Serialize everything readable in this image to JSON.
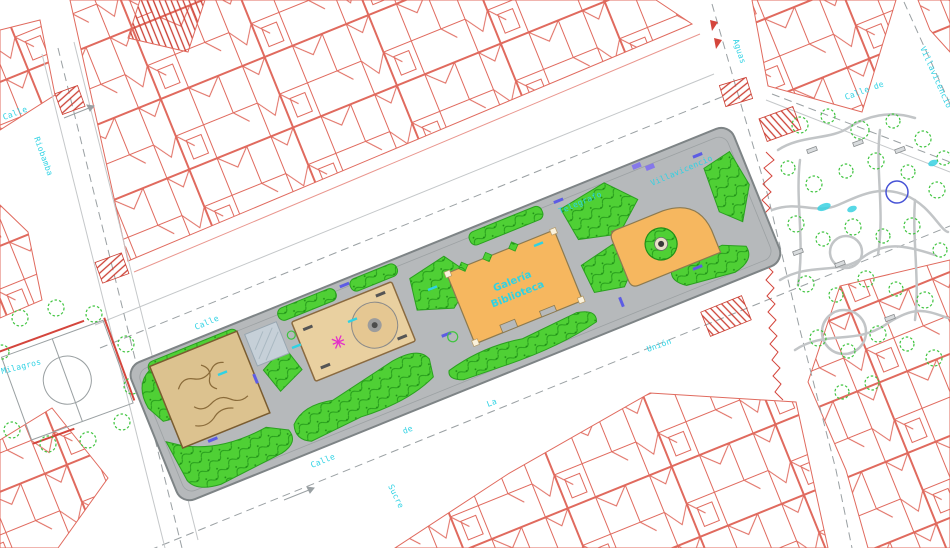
{
  "canvas": {
    "width": 950,
    "height": 548,
    "background": "#ffffff"
  },
  "palette": {
    "building_line": "#e06a5e",
    "crosswalk_red": "#cc4034",
    "plaza_gray": "#b6b9bb",
    "grass_green": "#4fd035",
    "grass_texture": "#259b1b",
    "sand_tan": "#dcc28f",
    "playground_tan": "#e9d0a0",
    "building_orange": "#f6b75f",
    "label_cyan": "#2fd2e4",
    "bench_blue": "#5d5ce4",
    "street_dash_gray": "#9aa0a3",
    "tree_green": "#3fc43f",
    "pond_blue": "#4753d6"
  },
  "plaza": {
    "building_label_line1": "Galería",
    "building_label_line2": "Biblioteca"
  },
  "street_labels": [
    {
      "text": "Calle",
      "x": 196,
      "y": 330,
      "rotate": -23
    },
    {
      "text": "Telegrafo",
      "x": 560,
      "y": 214,
      "rotate": -23
    },
    {
      "text": "Villavicencio",
      "x": 652,
      "y": 186,
      "rotate": -23
    },
    {
      "text": "Calle",
      "x": 312,
      "y": 468,
      "rotate": -22
    },
    {
      "text": "de",
      "x": 404,
      "y": 434,
      "rotate": -22
    },
    {
      "text": "La",
      "x": 488,
      "y": 407,
      "rotate": -21
    },
    {
      "text": "Unión",
      "x": 648,
      "y": 352,
      "rotate": -20
    },
    {
      "text": "Calle de",
      "x": 846,
      "y": 100,
      "rotate": -20
    },
    {
      "text": "Villavicencio",
      "x": 920,
      "y": 48,
      "rotate": 66
    },
    {
      "text": "Aguas",
      "x": 733,
      "y": 40,
      "rotate": 72
    },
    {
      "text": "Riobamba",
      "x": 34,
      "y": 138,
      "rotate": 70
    },
    {
      "text": "Calle",
      "x": 4,
      "y": 120,
      "rotate": -20
    },
    {
      "text": "Milagros",
      "x": 2,
      "y": 374,
      "rotate": -14
    },
    {
      "text": "Sucre",
      "x": 388,
      "y": 486,
      "rotate": 64
    }
  ]
}
